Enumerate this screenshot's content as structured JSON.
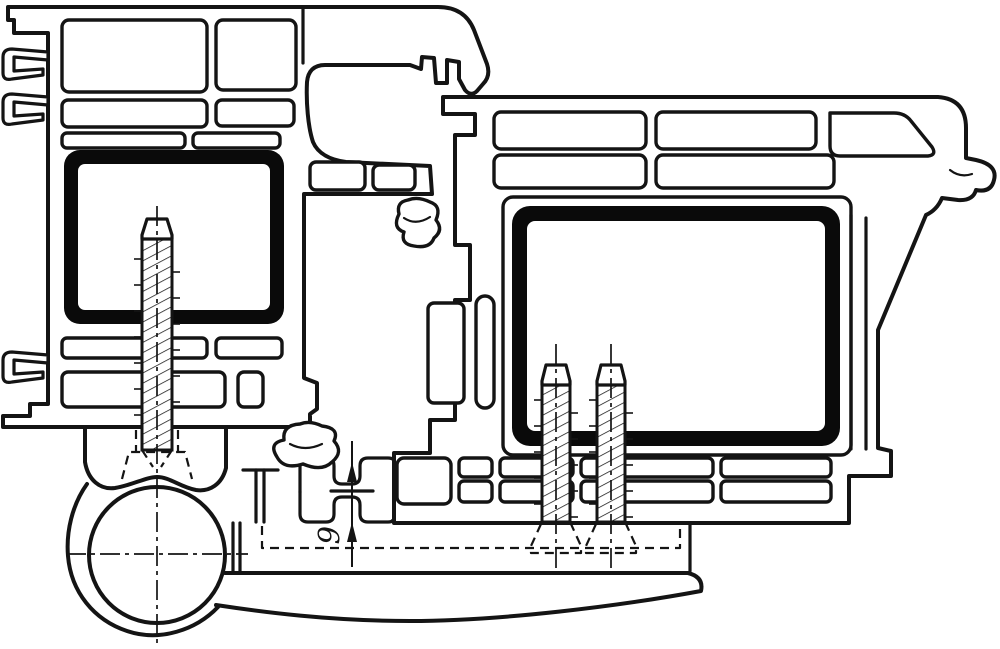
{
  "canvas": {
    "width": 1000,
    "height": 649,
    "background": "#ffffff"
  },
  "colors": {
    "line": "#141414",
    "steel_reinforcement_fill": "#0a0a0a",
    "paper": "#ffffff"
  },
  "drawing": {
    "type": "technical-cross-section",
    "subject": "door hinge mounted on PVC frame and sash profiles",
    "line_styles": [
      "solid outlines",
      "dashed hidden edges",
      "dash-dot centerlines",
      "hatched screw shafts"
    ]
  },
  "dimension": {
    "value": "6",
    "orientation": "vertical, text rotated 90°",
    "arrows": "two arrowheads pointing up"
  },
  "parts": {
    "frame_profile": "multi-chamber PVC frame profile (left)",
    "sash_profile": "multi-chamber PVC sash profile (right)",
    "steel_reinforcement_frame": "black hollow steel box in frame chamber",
    "steel_reinforcement_sash": "black hollow steel box in sash chamber",
    "frame_screw": "hatched fixing screw through frame into hinge body",
    "sash_screws": "two hatched fixing screws through sash into hinge leaf",
    "hinge_knuckle": "hinge barrel with centerlines (bottom left)",
    "hinge_leaf": "hinge leaf / arm sweeping right below sash",
    "gaskets": "mushroom-shaped sealing gaskets between profiles",
    "glazing_gasket": "curled gasket at top right of sash",
    "clips": "three barb clips on outer left face of frame"
  }
}
